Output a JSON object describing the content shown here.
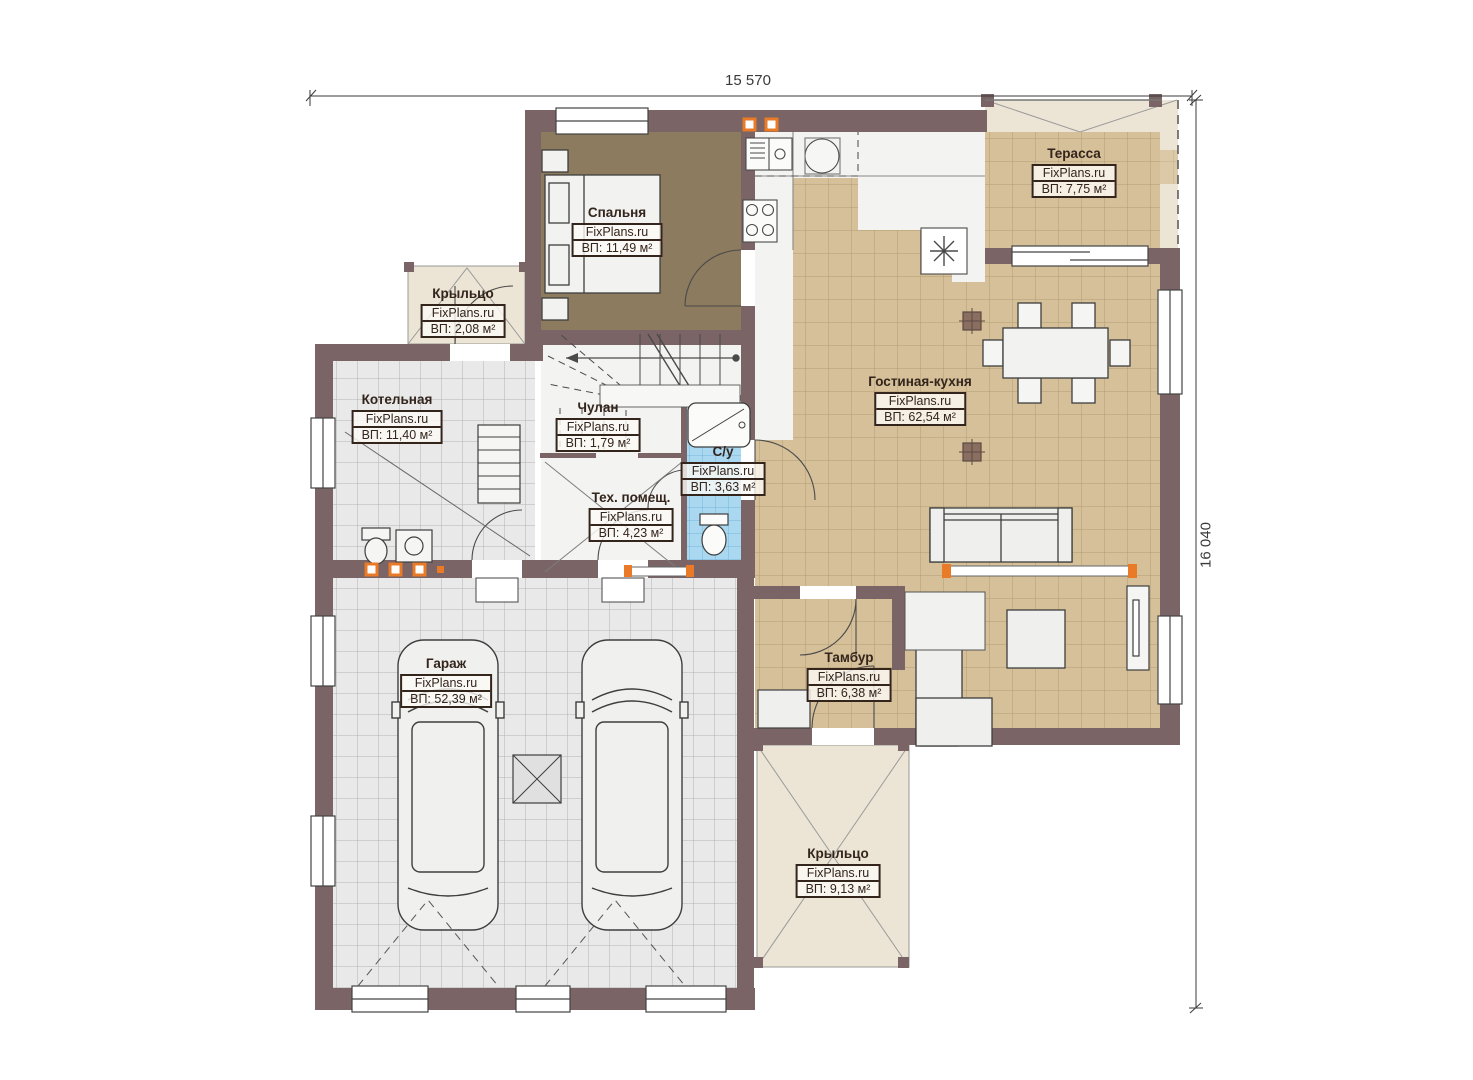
{
  "brand": "FixPlans.ru",
  "dimensions": {
    "width_label": "15 570",
    "height_label": "16 040"
  },
  "rooms": [
    {
      "name": "Спальня",
      "area": "ВП: 11,49 м²"
    },
    {
      "name": "Терасса",
      "area": "ВП: 7,75 м²"
    },
    {
      "name": "Крыльцо",
      "area": "ВП: 2,08 м²"
    },
    {
      "name": "Котельная",
      "area": "ВП: 11,40 м²"
    },
    {
      "name": "Чулан",
      "area": "ВП: 1,79 м²"
    },
    {
      "name": "С/у",
      "area": "ВП: 3,63 м²"
    },
    {
      "name": "Тех. помещ.",
      "area": "ВП: 4,23 м²"
    },
    {
      "name": "Гостиная-кухня",
      "area": "ВП: 62,54 м²"
    },
    {
      "name": "Гараж",
      "area": "ВП: 52,39 м²"
    },
    {
      "name": "Тамбур",
      "area": "ВП: 6,38 м²"
    },
    {
      "name": "Крыльцо",
      "area": "ВП: 9,13 м²"
    }
  ],
  "colors": {
    "wall": "#7a6465",
    "living_floor": "#d6c099",
    "bedroom_floor": "#8d7b5f",
    "bathroom_tile": "#a9d8f0",
    "garage_tile": "#e9e9e9",
    "porch": "#ece5d5",
    "accent_orange": "#e87a28"
  }
}
